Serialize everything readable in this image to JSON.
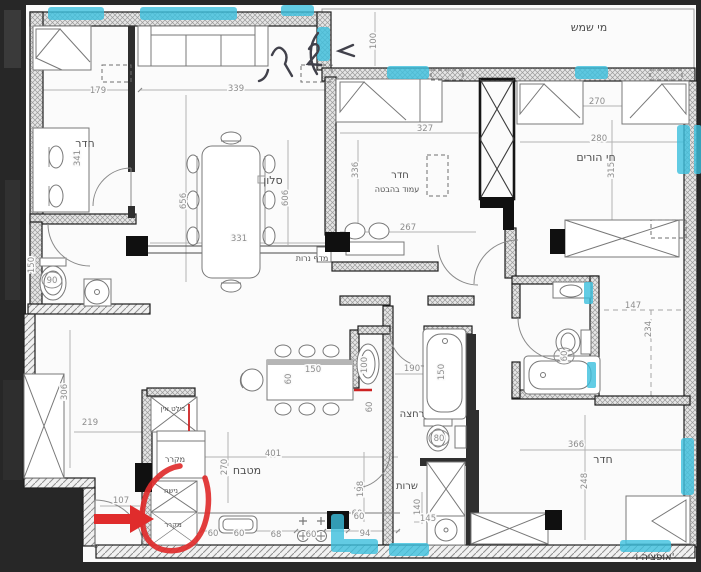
{
  "drawing": {
    "type": "apartment-floor-plan",
    "option_label": "אופציה ו'",
    "colors": {
      "paper": "#fbfbfb",
      "frame": "#272727",
      "wall_line": "#1f1f1f",
      "partition": "#2f2f2f",
      "label": "#4e4e4e",
      "dim": "#8d8d8d",
      "highlight": "#3cc0de",
      "annotation": "#e02c2c",
      "scribble": "#41414b"
    },
    "labels": [
      {
        "name": "label-solar-water",
        "t": "מי שמש",
        "x": 589,
        "y": 31,
        "s": 11
      },
      {
        "name": "label-room-topleft",
        "t": "חדר",
        "x": 85,
        "y": 147,
        "s": 11
      },
      {
        "name": "label-living",
        "t": "סלון",
        "x": 273,
        "y": 184,
        "s": 11
      },
      {
        "name": "label-candle-shelf",
        "t": "מדף נרות",
        "x": 312,
        "y": 261,
        "s": 8
      },
      {
        "name": "label-room-middle",
        "t": "חדר",
        "x": 400,
        "y": 178,
        "s": 10
      },
      {
        "name": "label-column-note",
        "t": "עמוד בהבטה",
        "x": 397,
        "y": 192,
        "s": 8
      },
      {
        "name": "label-parents-room",
        "t": "חי הורים",
        "x": 596,
        "y": 161,
        "s": 11
      },
      {
        "name": "label-kitchen",
        "t": "מטבח",
        "x": 247,
        "y": 474,
        "s": 11
      },
      {
        "name": "label-built-in",
        "t": "בילט אין",
        "x": 173,
        "y": 411,
        "s": 7
      },
      {
        "name": "label-fridge",
        "t": "מקרר",
        "x": 175,
        "y": 462,
        "s": 8
      },
      {
        "name": "label-niche",
        "t": "נישה",
        "x": 171,
        "y": 493,
        "s": 7
      },
      {
        "name": "label-fridge-2",
        "t": "מקרר",
        "x": 173,
        "y": 527,
        "s": 7
      },
      {
        "name": "label-bath",
        "t": "רחצה",
        "x": 412,
        "y": 417,
        "s": 10
      },
      {
        "name": "label-wc",
        "t": "שרות",
        "x": 407,
        "y": 489,
        "s": 10
      },
      {
        "name": "label-room-bottomright",
        "t": "חדר",
        "x": 603,
        "y": 463,
        "s": 11
      },
      {
        "name": "label-option",
        "t": "אופציה ו'",
        "x": 655,
        "y": 560,
        "s": 10,
        "c": "#3a3a3a"
      }
    ],
    "dims": [
      {
        "v": "179",
        "x": 98,
        "y": 93
      },
      {
        "v": "339",
        "x": 236,
        "y": 91
      },
      {
        "v": "341",
        "x": 80,
        "y": 158,
        "rot": -90
      },
      {
        "v": "656",
        "x": 186,
        "y": 201,
        "rot": -90
      },
      {
        "v": "606",
        "x": 288,
        "y": 198,
        "rot": -90
      },
      {
        "v": "331",
        "x": 239,
        "y": 241
      },
      {
        "v": "100",
        "x": 376,
        "y": 41,
        "rot": -90
      },
      {
        "v": "327",
        "x": 425,
        "y": 131
      },
      {
        "v": "336",
        "x": 358,
        "y": 170,
        "rot": -90
      },
      {
        "v": "267",
        "x": 408,
        "y": 230
      },
      {
        "v": "270",
        "x": 597,
        "y": 104
      },
      {
        "v": "280",
        "x": 599,
        "y": 141
      },
      {
        "v": "315",
        "x": 614,
        "y": 170,
        "rot": -90
      },
      {
        "v": "147",
        "x": 633,
        "y": 308
      },
      {
        "v": "234",
        "x": 651,
        "y": 329,
        "rot": -90
      },
      {
        "v": "190",
        "x": 412,
        "y": 371
      },
      {
        "v": "150",
        "x": 444,
        "y": 372,
        "rot": -90
      },
      {
        "v": "100",
        "x": 367,
        "y": 365,
        "rot": -90
      },
      {
        "v": "60",
        "x": 372,
        "y": 407,
        "rot": -90
      },
      {
        "v": "80",
        "x": 439,
        "y": 441,
        "circ": true
      },
      {
        "v": "198",
        "x": 363,
        "y": 489,
        "rot": -90
      },
      {
        "v": "140",
        "x": 420,
        "y": 507,
        "rot": -90
      },
      {
        "v": "145",
        "x": 428,
        "y": 521
      },
      {
        "v": "60",
        "x": 357,
        "y": 516
      },
      {
        "v": "94",
        "x": 365,
        "y": 536
      },
      {
        "v": "306",
        "x": 67,
        "y": 392,
        "rot": -90
      },
      {
        "v": "219",
        "x": 90,
        "y": 425
      },
      {
        "v": "107",
        "x": 121,
        "y": 503
      },
      {
        "v": "150",
        "x": 34,
        "y": 265,
        "rot": -90
      },
      {
        "v": "90",
        "x": 52,
        "y": 283,
        "circ": true
      },
      {
        "v": "401",
        "x": 273,
        "y": 456
      },
      {
        "v": "270",
        "x": 227,
        "y": 467,
        "rot": -90
      },
      {
        "v": "150",
        "x": 313,
        "y": 372
      },
      {
        "v": "60",
        "x": 291,
        "y": 379,
        "rot": -90
      },
      {
        "v": "60",
        "x": 213,
        "y": 536
      },
      {
        "v": "60",
        "x": 239,
        "y": 536
      },
      {
        "v": "68",
        "x": 276,
        "y": 537
      },
      {
        "v": "60",
        "x": 311,
        "y": 537
      },
      {
        "v": "60",
        "x": 359,
        "y": 519
      },
      {
        "v": "366",
        "x": 576,
        "y": 447
      },
      {
        "v": "248",
        "x": 587,
        "y": 481,
        "rot": -90
      },
      {
        "v": "60",
        "x": 567,
        "y": 356,
        "rot": -90,
        "circ": true
      }
    ]
  }
}
